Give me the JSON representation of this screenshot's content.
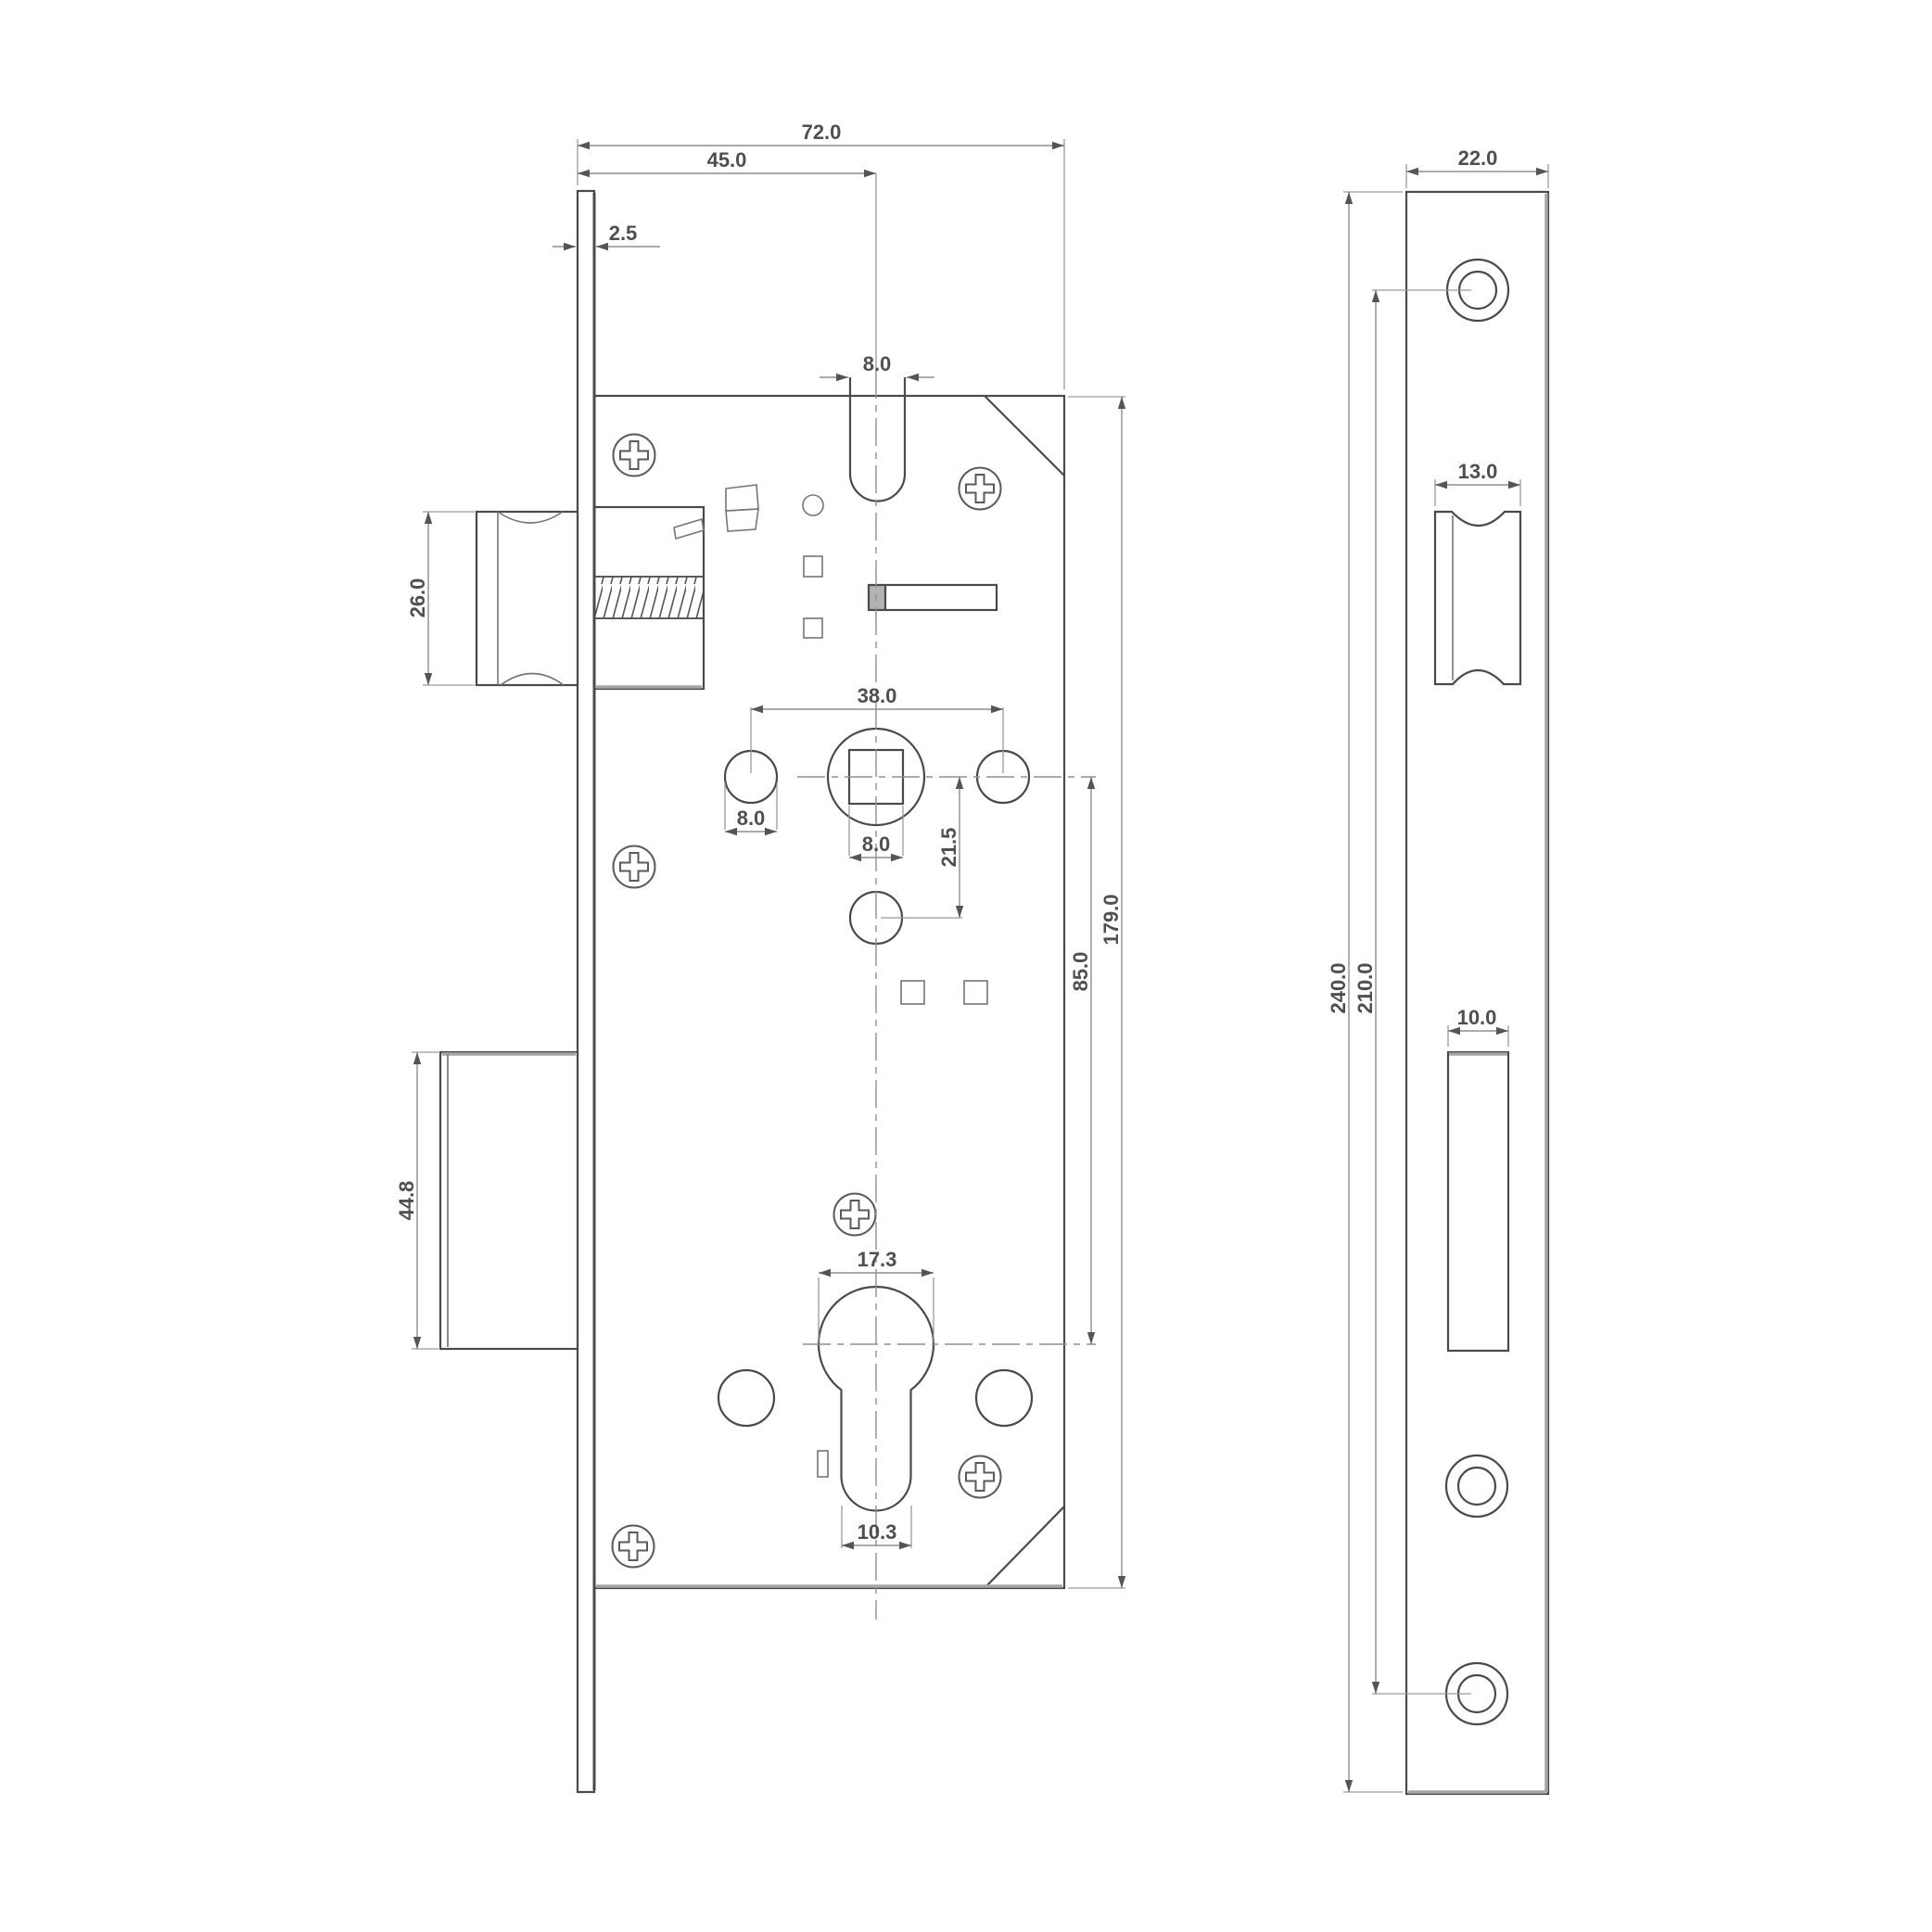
{
  "main_view": {
    "dim_overall_width": "72.0",
    "dim_backset": "45.0",
    "dim_faceplate_thickness": "2.5",
    "dim_top_slot_width": "8.0",
    "dim_latch_height": "26.0",
    "dim_hole_spacing": "38.0",
    "dim_side_hole": "8.0",
    "dim_spindle_square": "8.0",
    "dim_offset_21_5": "21.5",
    "dim_centers_85": "85.0",
    "dim_case_height": "179.0",
    "dim_cylinder_diameter": "17.3",
    "dim_cylinder_neck": "10.3",
    "dim_deadbolt_height": "44.8"
  },
  "side_view": {
    "dim_plate_width": "22.0",
    "dim_latch_cutout": "13.0",
    "dim_deadbolt_cutout": "10.0",
    "dim_plate_height": "240.0",
    "dim_screw_spacing": "210.0"
  }
}
